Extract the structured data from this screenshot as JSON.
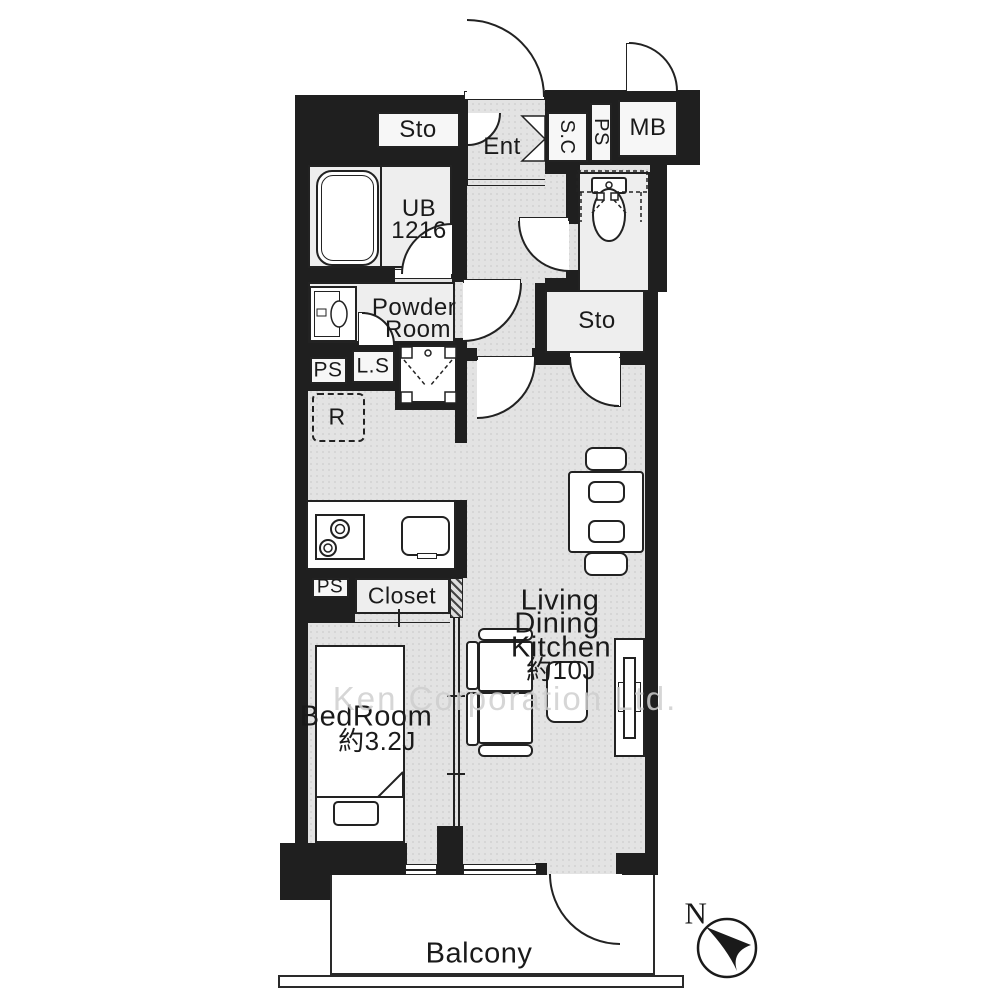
{
  "plan": {
    "watermark": "Ken Corporation Ltd.",
    "compass_north": "N",
    "rooms": {
      "sto_top": "Sto",
      "entrance": "Ent",
      "shoe_closet": "S.C",
      "pipe_space_top": "PS",
      "meter_box": "MB",
      "unit_bath_line1": "UB",
      "unit_bath_line2": "1216",
      "powder_line1": "Powder",
      "powder_line2": "Room",
      "pipe_space_mid": "PS",
      "laundry_space": "L.S",
      "refrigerator": "R",
      "storage": "Sto",
      "pipe_space_bottom": "PS",
      "closet": "Closet",
      "bedroom_name": "BedRoom",
      "bedroom_size": "約3.2J",
      "ldk_line1": "Living",
      "ldk_line2": "Dining",
      "ldk_line3": "Kitchen",
      "ldk_size": "約10J",
      "balcony": "Balcony"
    },
    "colors": {
      "wall": "#1f1f1f",
      "floor": "#e3e3e3",
      "room_light": "#eeeeee",
      "furniture": "#ffffff",
      "text": "#1a1a1a",
      "watermark": "#cfcfcf"
    }
  }
}
